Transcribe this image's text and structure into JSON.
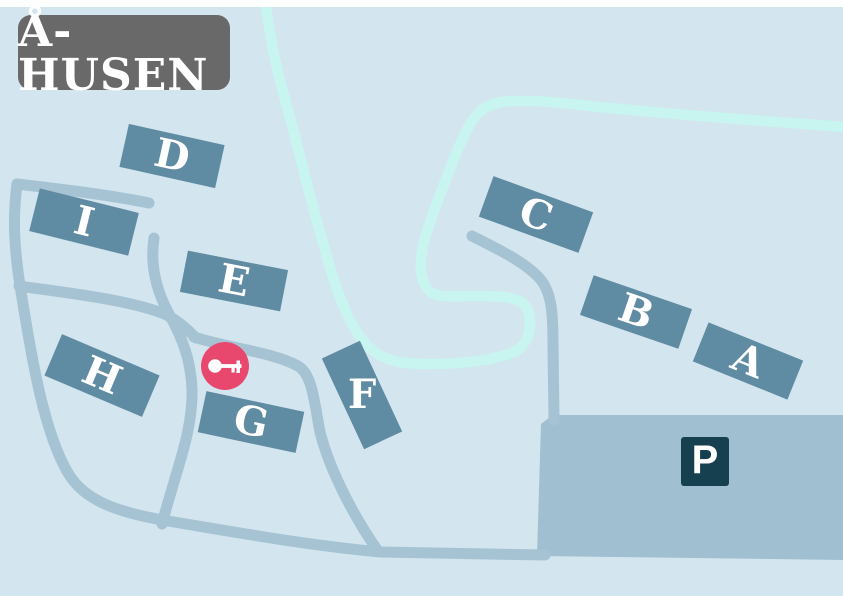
{
  "title": "Å-HUSEN",
  "map": {
    "buildings": [
      {
        "id": "A",
        "label": "A"
      },
      {
        "id": "B",
        "label": "B"
      },
      {
        "id": "C",
        "label": "C"
      },
      {
        "id": "D",
        "label": "D"
      },
      {
        "id": "E",
        "label": "E"
      },
      {
        "id": "F",
        "label": "F"
      },
      {
        "id": "G",
        "label": "G"
      },
      {
        "id": "H",
        "label": "H"
      },
      {
        "id": "I",
        "label": "I"
      }
    ],
    "parking": {
      "label": "P"
    },
    "markers": [
      {
        "id": "key",
        "icon": "key-icon",
        "meaning": "entrance-key-location"
      }
    ]
  },
  "colors": {
    "background": "#d3e5ee",
    "road": "#a6c3d4",
    "river": "#c8f5f0",
    "building": "#5f8ba3",
    "parking_area": "#a0bfd0",
    "parking_sign": "#16404f",
    "key_marker": "#e8486e",
    "title_box": "#696969",
    "label_text": "#ffffff"
  }
}
